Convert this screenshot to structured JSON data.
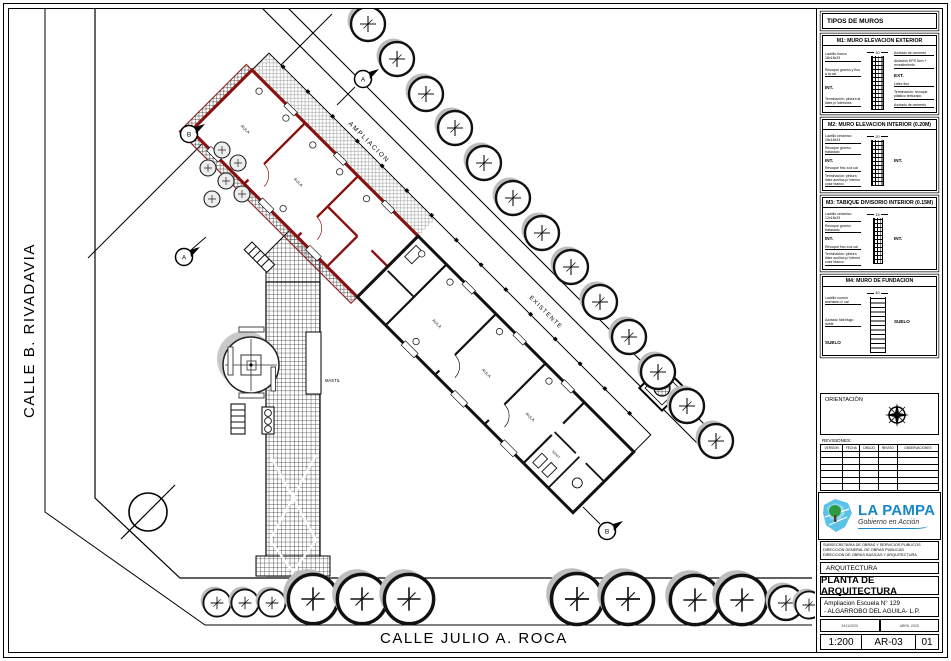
{
  "plan": {
    "street_left": "CALLE  B. RIVADAVIA",
    "street_bottom": "CALLE  JULIO A. ROCA",
    "label_ampliacion": "AMPLIACION",
    "label_existente": "EXISTENTE",
    "label_mastil": "MASTIL",
    "rooms": {
      "aula": "AULA",
      "sanit": "SANIT."
    },
    "markers": {
      "m1": "A",
      "m2": "B",
      "m3": "A",
      "m4": "B"
    }
  },
  "panel": {
    "tipos_header": "TIPOS DE MUROS",
    "m1": {
      "title": "M1: MURO ELEVACION EXTERIOR",
      "dim": "30",
      "left": [
        "Ladrillo hueco 18x18x33",
        "Revoque grueso y fino a la cal",
        "INT.",
        "Terminación: pintura al látex p/ interiores"
      ],
      "right": [
        "Azotado de cemento",
        "Aislación EPS 5cm + revestimiento",
        "EXT.",
        "Látex fino",
        "Terminación: revoque plástico texturado",
        "Azotado de cemento"
      ]
    },
    "m2": {
      "title": "M2: MURO ELEVACION INTERIOR (0.20M)",
      "dim": "20",
      "left": [
        "Ladrillo cerámico 18x18x33",
        "Revoque grueso fratasado",
        "INT.",
        "Revoque fino a la cal",
        "Terminación: pintura látex acrílica p/ interior color blanco"
      ],
      "right": [
        "INT."
      ]
    },
    "m3": {
      "title": "M3: TABIQUE DIVISORIO INTERIOR (0.15M)",
      "dim": "15",
      "left": [
        "Ladrillo cerámico 12x18x33",
        "Revoque grueso fratasado",
        "INT.",
        "Revoque fino a la cal",
        "Terminación: pintura látex acrílica p/ interior color blanco"
      ],
      "right": [
        "INT."
      ]
    },
    "m4": {
      "title": "M4: MURO DE FUNDACION",
      "dim": "40",
      "left": [
        "Ladrillo común asentado c/ cal",
        "Azotado hidrófugo doble",
        "SUELO"
      ],
      "right": [
        "SUELO"
      ]
    },
    "orientacion_label": "ORIENTACIÓN",
    "revisiones_label": "REVISIONES:",
    "rev_cols": [
      "VERSION",
      "FECHA",
      "DIBUJO",
      "REVISO",
      "OBSERVACIONES"
    ],
    "logo": {
      "name": "LA PAMPA",
      "tagline": "Gobierno en Acción"
    },
    "dept_lines": [
      "SUBSECRETARIA DE OBRAS Y SERVICIOS PUBLICOS",
      "DIRECCION GENERAL DE OBRAS PUBLICAS",
      "DIRECCION DE OBRAS BASICAS Y ARQUITECTURA"
    ],
    "area_label": "ARQUITECTURA",
    "sheet_title": "PLANTA DE ARQUITECTURA",
    "project_line1": "Ampliacion Escuela N° 129",
    "project_line2": "- ALGARROBO DEL AGUILA- L.P.",
    "expediente": "3411/2020",
    "fecha": "ABRIL 2025",
    "escala": "1:200",
    "plano_num": "AR-03",
    "revision": "01"
  },
  "colors": {
    "wall_new": "#8a1111",
    "logo_blue": "#1787c8",
    "logo_green": "#2e9b3e"
  }
}
